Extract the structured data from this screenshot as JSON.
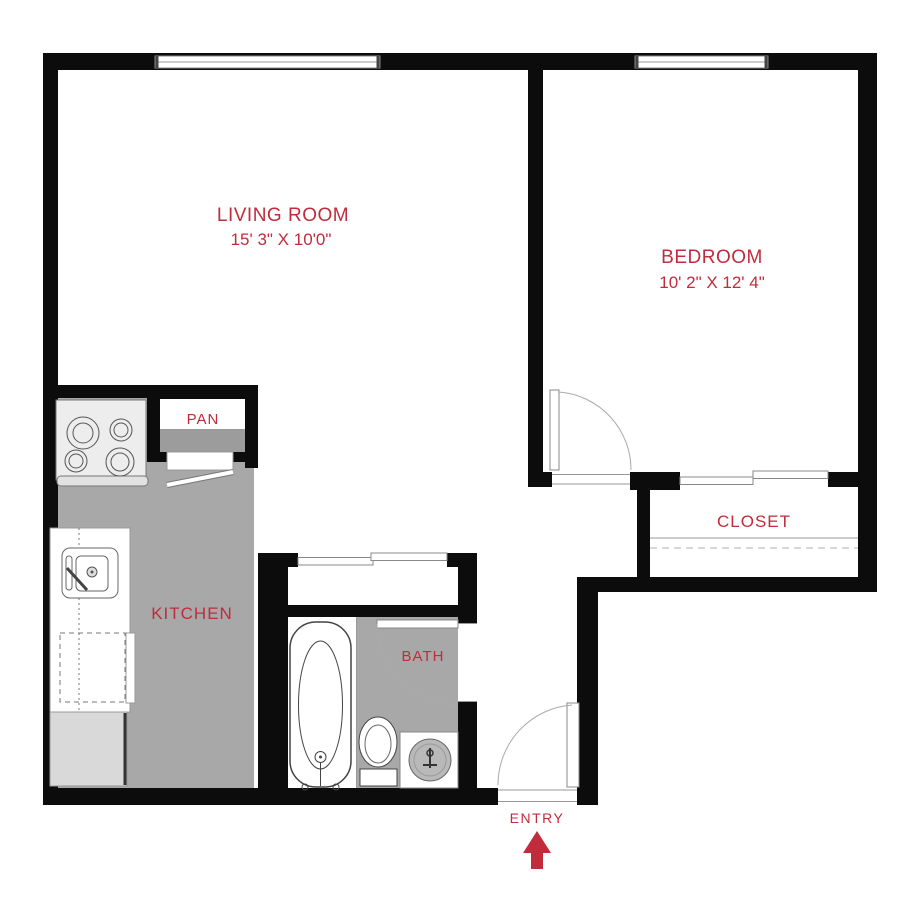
{
  "title": "One Bedroom Apartment Floor Plan",
  "colors": {
    "wall": "#0c0c0c",
    "accent": "#c02c3c",
    "floor": "#a8a8a8"
  },
  "rooms": {
    "living_room": {
      "label": "LIVING ROOM",
      "dims": "15' 3\" X 10'0\""
    },
    "bedroom": {
      "label": "BEDROOM",
      "dims": "10' 2\" X 12' 4\""
    },
    "kitchen": {
      "label": "KITCHEN"
    },
    "bath": {
      "label": "BATH"
    },
    "closet": {
      "label": "CLOSET"
    },
    "pantry": {
      "label": "PAN"
    }
  },
  "entry": {
    "label": "ENTRY",
    "arrow_icon": "up-arrow",
    "arrow_color": "#c02c3c"
  },
  "fixtures": [
    "stove",
    "kitchen-sink",
    "counter",
    "dishwasher",
    "refrigerator",
    "bathtub",
    "toilet",
    "vanity-sink",
    "closet-shelf",
    "windows",
    "doors"
  ]
}
